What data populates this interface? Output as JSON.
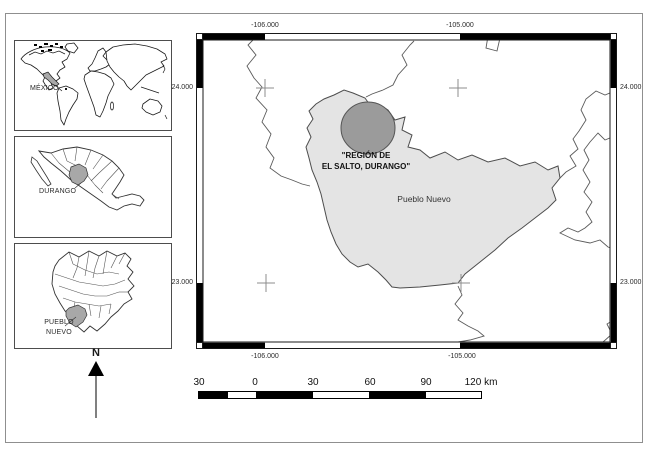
{
  "colors": {
    "highlight_gray": "#a8a8a8",
    "municipality_fill": "#e4e4e4",
    "region_circle_fill": "#9b9b9b",
    "boundary_line": "#4d4d4d"
  },
  "insets": {
    "world": {
      "label": "MÉXICO"
    },
    "mexico": {
      "label": "DURANGO"
    },
    "durango": {
      "label_line1": "PUEBLO",
      "label_line2": "NUEVO"
    }
  },
  "north_arrow": {
    "label": "N"
  },
  "main_map": {
    "graticule": {
      "top": [
        "-106.000",
        "-105.000"
      ],
      "bottom": [
        "-106.000",
        "-105.000"
      ],
      "left": [
        "24.000",
        "23.000"
      ],
      "right": [
        "24.000",
        "23.000"
      ]
    },
    "region_label_line1": "\"REGIÓN DE",
    "region_label_line2": "EL SALTO, DURANGO\"",
    "municipality_label": "Pueblo Nuevo"
  },
  "scale_bar": {
    "labels": [
      "30",
      "0",
      "30",
      "60",
      "90"
    ],
    "end_label": "120 km"
  }
}
